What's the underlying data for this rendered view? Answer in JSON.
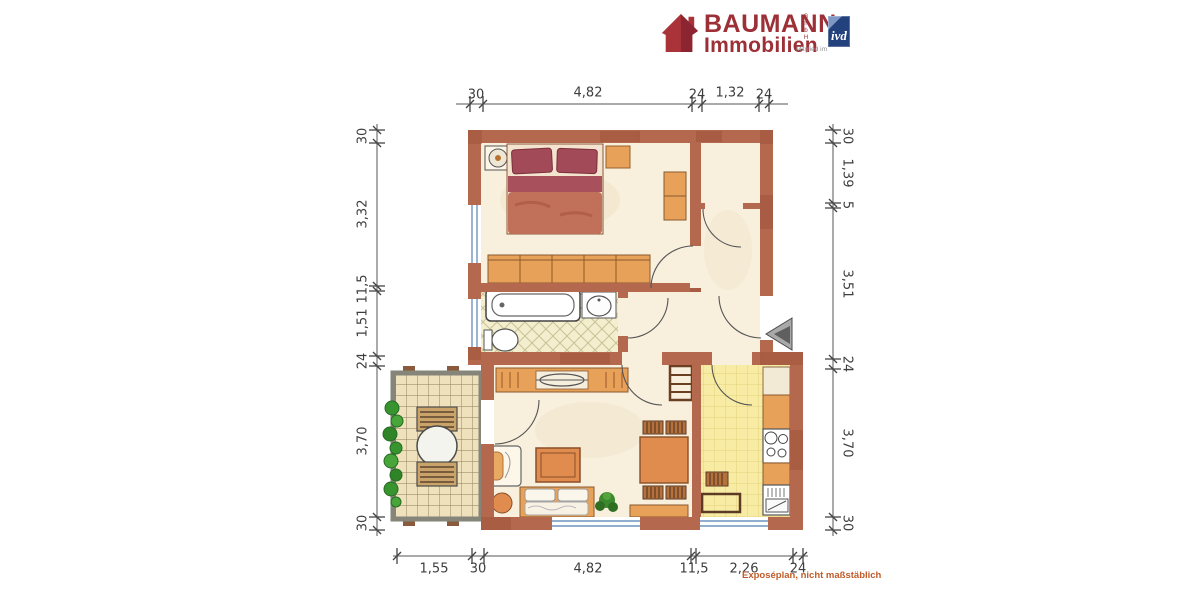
{
  "brand": {
    "name": "BAUMANN",
    "name_line2": "Immobilien",
    "legal_suffix": "GmbH",
    "member_label": "Mitglied im",
    "badge_label": "ivd",
    "brand_color": "#9d3036",
    "badge_color": "#23417c"
  },
  "footer": {
    "note": "Exposéplan, nicht maßstäblich",
    "note_color": "#bf5b28"
  },
  "floorplan": {
    "type": "apartment-floor-plan",
    "wall_color": "#b4684e",
    "floor_color": "#f8efdc",
    "bathroom_tile_color": "#f3efce",
    "kitchen_tile_color": "#f8eca4",
    "balcony_tile_color": "#efe1bb",
    "window_color": "#6f94bd",
    "furniture_color": "#e7a158",
    "bed_color": "#a34a58",
    "rooms": [
      "bedroom",
      "hallway",
      "bathroom",
      "living-room",
      "kitchen",
      "balcony"
    ],
    "dimensions": {
      "top": [
        "30",
        "4,82",
        "24",
        "1,32",
        "24"
      ],
      "bottom": [
        "1,55",
        "30",
        "4,82",
        "11,5",
        "2,26",
        "24"
      ],
      "left": [
        "30",
        "3,32",
        "11,5",
        "1,51",
        "24",
        "3,70",
        "30"
      ],
      "right": [
        "30",
        "1,39",
        "5",
        "3,51",
        "24",
        "3,70",
        "30"
      ]
    },
    "icons": {
      "house_icon": "brand house mark",
      "entry_arrow_icon": "entrance direction arrow",
      "plant_icon": "potted plant"
    }
  }
}
